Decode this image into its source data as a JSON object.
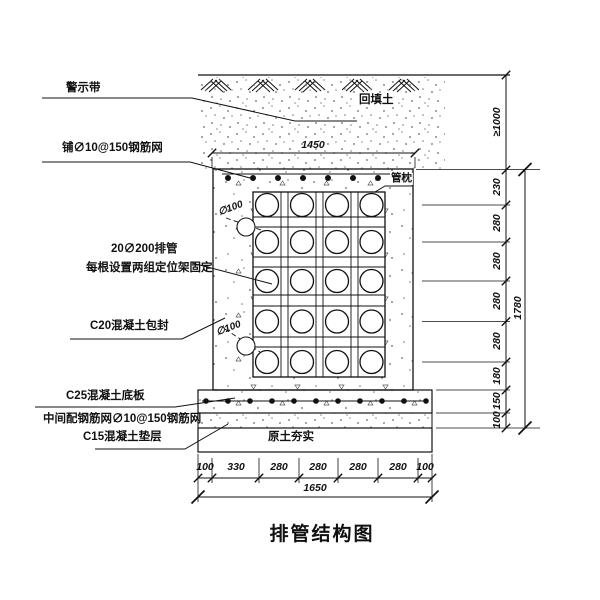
{
  "title": "排管结构图",
  "labels": {
    "warning_tape": "警示带",
    "top_mesh": "铺∅10@150钢筋网",
    "pipes_line1": "20∅200排管",
    "pipes_line2": "每根设置两组定位架固定",
    "c20_seal": "C20混凝土包封",
    "c25_slab": "C25混凝土底板",
    "mid_mesh": "中间配钢筋网∅10@150钢筋网",
    "c15_cushion": "C15混凝土垫层",
    "backfill": "回填土",
    "pipe_pillow": "管枕",
    "soil_compact": "原土夯实",
    "pipe_dia_upper": "∅100",
    "pipe_dia_lower": "∅100"
  },
  "dims": {
    "top_width": "1450",
    "bottom_row": [
      "100",
      "330",
      "280",
      "280",
      "280",
      "280",
      "100"
    ],
    "bottom_total": "1650",
    "right_cover": "≥1000",
    "right_row": [
      "230",
      "280",
      "280",
      "280",
      "280",
      "180",
      "150",
      "100"
    ],
    "right_total": "1780"
  },
  "drawing": {
    "line_color": "#111111",
    "background": "#ffffff",
    "pipe_grid": {
      "columns": 4,
      "rows": 5
    }
  }
}
